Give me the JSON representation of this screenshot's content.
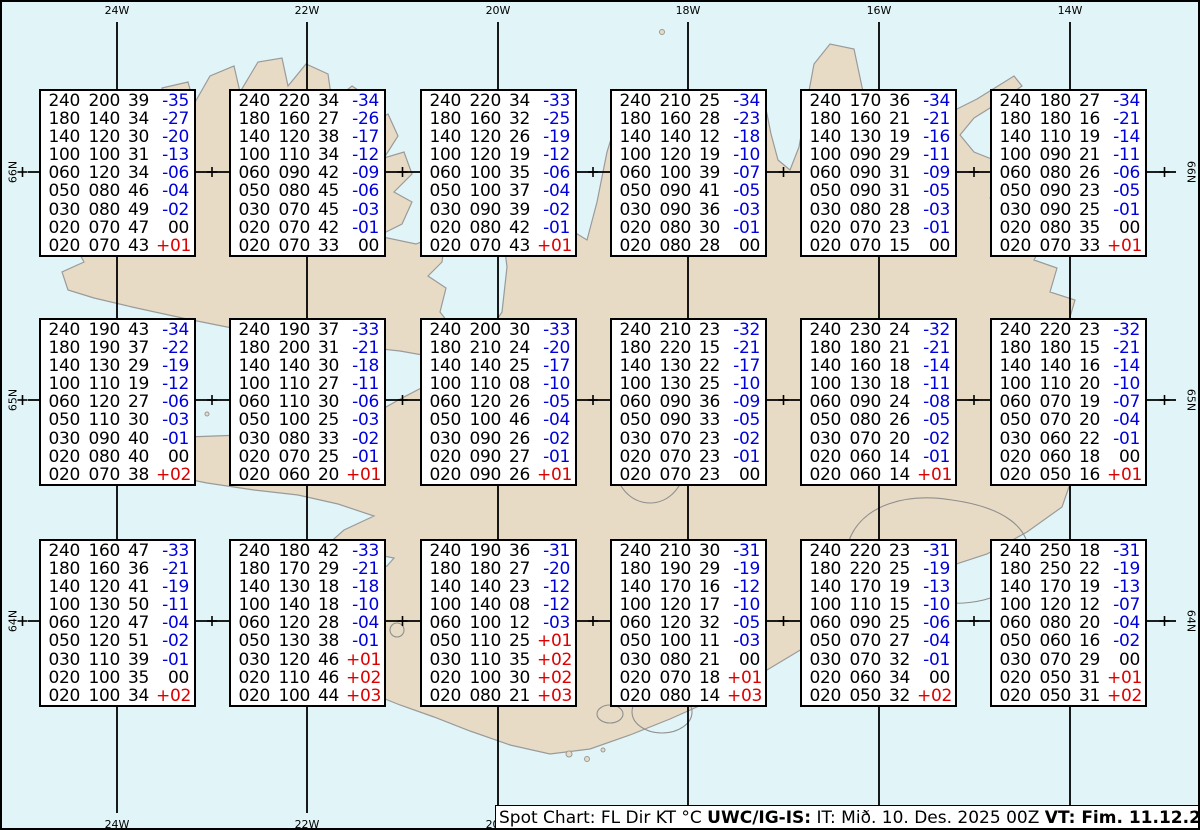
{
  "grid": {
    "top_longitude_labels": [
      "24W",
      "22W",
      "20W",
      "18W",
      "16W",
      "14W"
    ],
    "bottom_longitude_labels": [
      "24W",
      "22W",
      "20W"
    ],
    "left_latitude_labels": [
      "66N",
      "65N",
      "64N"
    ],
    "right_latitude_labels": [
      "66N",
      "65N",
      "64N"
    ]
  },
  "caption": {
    "segments": [
      {
        "text": "Spot Chart: FL Dir KT °C ",
        "bold": false
      },
      {
        "text": "UWC/IG-IS:",
        "bold": true
      },
      {
        "text": " IT: Mið. 10. Des. 2025 00Z ",
        "bold": false
      },
      {
        "text": "VT: Fim. 11.12.2025 01Z",
        "bold": true
      },
      {
        "text": " (+25 h)",
        "bold": false
      }
    ]
  },
  "colors": {
    "sea": "#e1f5f8",
    "land": "#e8dbc5",
    "coastline": "#9a9a9a",
    "negative_temp": "#0000dd",
    "positive_temp": "#dd0000",
    "grid_line": "#000000"
  },
  "chart_data": {
    "type": "table",
    "columns": [
      "FL",
      "Dir",
      "KT",
      "°C"
    ],
    "title": "Spot Chart: FL Dir KT °C UWC/IG-IS: IT: Mið. 10. Des. 2025 00Z VT: Fim. 11.12.2025 01Z (+25 h)",
    "stations": [
      {
        "row": 1,
        "col": 1,
        "rows": [
          [
            "240",
            "200",
            "39",
            "-35"
          ],
          [
            "180",
            "140",
            "34",
            "-27"
          ],
          [
            "140",
            "120",
            "30",
            "-20"
          ],
          [
            "100",
            "100",
            "31",
            "-13"
          ],
          [
            "060",
            "120",
            "34",
            "-06"
          ],
          [
            "050",
            "080",
            "46",
            "-04"
          ],
          [
            "030",
            "080",
            "49",
            "-02"
          ],
          [
            "020",
            "070",
            "47",
            "00"
          ],
          [
            "020",
            "070",
            "43",
            "+01"
          ]
        ]
      },
      {
        "row": 1,
        "col": 2,
        "rows": [
          [
            "240",
            "220",
            "34",
            "-34"
          ],
          [
            "180",
            "160",
            "27",
            "-26"
          ],
          [
            "140",
            "120",
            "38",
            "-17"
          ],
          [
            "100",
            "110",
            "34",
            "-12"
          ],
          [
            "060",
            "090",
            "42",
            "-09"
          ],
          [
            "050",
            "080",
            "45",
            "-06"
          ],
          [
            "030",
            "070",
            "45",
            "-03"
          ],
          [
            "020",
            "070",
            "42",
            "-01"
          ],
          [
            "020",
            "070",
            "33",
            "00"
          ]
        ]
      },
      {
        "row": 1,
        "col": 3,
        "rows": [
          [
            "240",
            "220",
            "34",
            "-33"
          ],
          [
            "180",
            "160",
            "32",
            "-25"
          ],
          [
            "140",
            "120",
            "26",
            "-19"
          ],
          [
            "100",
            "120",
            "19",
            "-12"
          ],
          [
            "060",
            "100",
            "35",
            "-06"
          ],
          [
            "050",
            "100",
            "37",
            "-04"
          ],
          [
            "030",
            "090",
            "39",
            "-02"
          ],
          [
            "020",
            "080",
            "42",
            "-01"
          ],
          [
            "020",
            "070",
            "43",
            "+01"
          ]
        ]
      },
      {
        "row": 1,
        "col": 4,
        "rows": [
          [
            "240",
            "210",
            "25",
            "-34"
          ],
          [
            "180",
            "160",
            "28",
            "-23"
          ],
          [
            "140",
            "140",
            "12",
            "-18"
          ],
          [
            "100",
            "120",
            "19",
            "-10"
          ],
          [
            "060",
            "100",
            "39",
            "-07"
          ],
          [
            "050",
            "090",
            "41",
            "-05"
          ],
          [
            "030",
            "090",
            "36",
            "-03"
          ],
          [
            "020",
            "080",
            "30",
            "-01"
          ],
          [
            "020",
            "080",
            "28",
            "00"
          ]
        ]
      },
      {
        "row": 1,
        "col": 5,
        "rows": [
          [
            "240",
            "170",
            "36",
            "-34"
          ],
          [
            "180",
            "160",
            "21",
            "-21"
          ],
          [
            "140",
            "130",
            "19",
            "-16"
          ],
          [
            "100",
            "090",
            "29",
            "-11"
          ],
          [
            "060",
            "090",
            "31",
            "-09"
          ],
          [
            "050",
            "090",
            "31",
            "-05"
          ],
          [
            "030",
            "080",
            "28",
            "-03"
          ],
          [
            "020",
            "070",
            "23",
            "-01"
          ],
          [
            "020",
            "070",
            "15",
            "00"
          ]
        ]
      },
      {
        "row": 1,
        "col": 6,
        "rows": [
          [
            "240",
            "180",
            "27",
            "-34"
          ],
          [
            "180",
            "180",
            "16",
            "-21"
          ],
          [
            "140",
            "110",
            "19",
            "-14"
          ],
          [
            "100",
            "090",
            "21",
            "-11"
          ],
          [
            "060",
            "080",
            "26",
            "-06"
          ],
          [
            "050",
            "090",
            "23",
            "-05"
          ],
          [
            "030",
            "090",
            "25",
            "-01"
          ],
          [
            "020",
            "080",
            "35",
            "00"
          ],
          [
            "020",
            "070",
            "33",
            "+01"
          ]
        ]
      },
      {
        "row": 2,
        "col": 1,
        "rows": [
          [
            "240",
            "190",
            "43",
            "-34"
          ],
          [
            "180",
            "190",
            "37",
            "-22"
          ],
          [
            "140",
            "130",
            "29",
            "-19"
          ],
          [
            "100",
            "110",
            "19",
            "-12"
          ],
          [
            "060",
            "120",
            "27",
            "-06"
          ],
          [
            "050",
            "110",
            "30",
            "-03"
          ],
          [
            "030",
            "090",
            "40",
            "-01"
          ],
          [
            "020",
            "080",
            "40",
            "00"
          ],
          [
            "020",
            "070",
            "38",
            "+02"
          ]
        ]
      },
      {
        "row": 2,
        "col": 2,
        "rows": [
          [
            "240",
            "190",
            "37",
            "-33"
          ],
          [
            "180",
            "200",
            "31",
            "-21"
          ],
          [
            "140",
            "140",
            "30",
            "-18"
          ],
          [
            "100",
            "110",
            "27",
            "-11"
          ],
          [
            "060",
            "110",
            "30",
            "-06"
          ],
          [
            "050",
            "100",
            "25",
            "-03"
          ],
          [
            "030",
            "080",
            "33",
            "-02"
          ],
          [
            "020",
            "070",
            "25",
            "-01"
          ],
          [
            "020",
            "060",
            "20",
            "+01"
          ]
        ]
      },
      {
        "row": 2,
        "col": 3,
        "rows": [
          [
            "240",
            "200",
            "30",
            "-33"
          ],
          [
            "180",
            "210",
            "24",
            "-20"
          ],
          [
            "140",
            "140",
            "25",
            "-17"
          ],
          [
            "100",
            "110",
            "08",
            "-10"
          ],
          [
            "060",
            "120",
            "26",
            "-05"
          ],
          [
            "050",
            "100",
            "46",
            "-04"
          ],
          [
            "030",
            "090",
            "26",
            "-02"
          ],
          [
            "020",
            "090",
            "27",
            "-01"
          ],
          [
            "020",
            "090",
            "26",
            "+01"
          ]
        ]
      },
      {
        "row": 2,
        "col": 4,
        "rows": [
          [
            "240",
            "210",
            "23",
            "-32"
          ],
          [
            "180",
            "220",
            "15",
            "-21"
          ],
          [
            "140",
            "130",
            "22",
            "-17"
          ],
          [
            "100",
            "130",
            "25",
            "-10"
          ],
          [
            "060",
            "090",
            "36",
            "-09"
          ],
          [
            "050",
            "090",
            "33",
            "-05"
          ],
          [
            "030",
            "070",
            "23",
            "-02"
          ],
          [
            "020",
            "070",
            "23",
            "-01"
          ],
          [
            "020",
            "070",
            "23",
            "00"
          ]
        ]
      },
      {
        "row": 2,
        "col": 5,
        "rows": [
          [
            "240",
            "230",
            "24",
            "-32"
          ],
          [
            "180",
            "180",
            "21",
            "-21"
          ],
          [
            "140",
            "160",
            "18",
            "-14"
          ],
          [
            "100",
            "130",
            "18",
            "-11"
          ],
          [
            "060",
            "090",
            "24",
            "-08"
          ],
          [
            "050",
            "080",
            "26",
            "-05"
          ],
          [
            "030",
            "070",
            "20",
            "-02"
          ],
          [
            "020",
            "060",
            "14",
            "-01"
          ],
          [
            "020",
            "060",
            "14",
            "+01"
          ]
        ]
      },
      {
        "row": 2,
        "col": 6,
        "rows": [
          [
            "240",
            "220",
            "23",
            "-32"
          ],
          [
            "180",
            "180",
            "15",
            "-21"
          ],
          [
            "140",
            "140",
            "16",
            "-14"
          ],
          [
            "100",
            "110",
            "20",
            "-10"
          ],
          [
            "060",
            "070",
            "19",
            "-07"
          ],
          [
            "050",
            "070",
            "20",
            "-04"
          ],
          [
            "030",
            "060",
            "22",
            "-01"
          ],
          [
            "020",
            "060",
            "18",
            "00"
          ],
          [
            "020",
            "050",
            "16",
            "+01"
          ]
        ]
      },
      {
        "row": 3,
        "col": 1,
        "rows": [
          [
            "240",
            "160",
            "47",
            "-33"
          ],
          [
            "180",
            "160",
            "36",
            "-21"
          ],
          [
            "140",
            "120",
            "41",
            "-19"
          ],
          [
            "100",
            "130",
            "50",
            "-11"
          ],
          [
            "060",
            "120",
            "47",
            "-04"
          ],
          [
            "050",
            "120",
            "51",
            "-02"
          ],
          [
            "030",
            "110",
            "39",
            "-01"
          ],
          [
            "020",
            "100",
            "35",
            "00"
          ],
          [
            "020",
            "100",
            "34",
            "+02"
          ]
        ]
      },
      {
        "row": 3,
        "col": 2,
        "rows": [
          [
            "240",
            "180",
            "42",
            "-33"
          ],
          [
            "180",
            "170",
            "29",
            "-21"
          ],
          [
            "140",
            "130",
            "18",
            "-18"
          ],
          [
            "100",
            "140",
            "18",
            "-10"
          ],
          [
            "060",
            "120",
            "28",
            "-04"
          ],
          [
            "050",
            "130",
            "38",
            "-01"
          ],
          [
            "030",
            "120",
            "46",
            "+01"
          ],
          [
            "020",
            "110",
            "46",
            "+02"
          ],
          [
            "020",
            "100",
            "44",
            "+03"
          ]
        ]
      },
      {
        "row": 3,
        "col": 3,
        "rows": [
          [
            "240",
            "190",
            "36",
            "-31"
          ],
          [
            "180",
            "180",
            "27",
            "-20"
          ],
          [
            "140",
            "140",
            "23",
            "-12"
          ],
          [
            "100",
            "140",
            "08",
            "-12"
          ],
          [
            "060",
            "100",
            "12",
            "-03"
          ],
          [
            "050",
            "110",
            "25",
            "+01"
          ],
          [
            "030",
            "110",
            "35",
            "+02"
          ],
          [
            "020",
            "100",
            "30",
            "+02"
          ],
          [
            "020",
            "080",
            "21",
            "+03"
          ]
        ]
      },
      {
        "row": 3,
        "col": 4,
        "rows": [
          [
            "240",
            "210",
            "30",
            "-31"
          ],
          [
            "180",
            "190",
            "29",
            "-19"
          ],
          [
            "140",
            "170",
            "16",
            "-12"
          ],
          [
            "100",
            "120",
            "17",
            "-10"
          ],
          [
            "060",
            "120",
            "32",
            "-05"
          ],
          [
            "050",
            "100",
            "11",
            "-03"
          ],
          [
            "030",
            "080",
            "21",
            "00"
          ],
          [
            "020",
            "070",
            "18",
            "+01"
          ],
          [
            "020",
            "080",
            "14",
            "+03"
          ]
        ]
      },
      {
        "row": 3,
        "col": 5,
        "rows": [
          [
            "240",
            "220",
            "23",
            "-31"
          ],
          [
            "180",
            "220",
            "25",
            "-19"
          ],
          [
            "140",
            "170",
            "19",
            "-13"
          ],
          [
            "100",
            "110",
            "15",
            "-10"
          ],
          [
            "060",
            "090",
            "25",
            "-06"
          ],
          [
            "050",
            "070",
            "27",
            "-04"
          ],
          [
            "030",
            "070",
            "32",
            "-01"
          ],
          [
            "020",
            "060",
            "34",
            "00"
          ],
          [
            "020",
            "050",
            "32",
            "+02"
          ]
        ]
      },
      {
        "row": 3,
        "col": 6,
        "rows": [
          [
            "240",
            "250",
            "18",
            "-31"
          ],
          [
            "180",
            "250",
            "22",
            "-19"
          ],
          [
            "140",
            "170",
            "19",
            "-13"
          ],
          [
            "100",
            "120",
            "12",
            "-07"
          ],
          [
            "060",
            "080",
            "20",
            "-04"
          ],
          [
            "050",
            "060",
            "16",
            "-02"
          ],
          [
            "030",
            "070",
            "29",
            "00"
          ],
          [
            "020",
            "050",
            "31",
            "+01"
          ],
          [
            "020",
            "050",
            "31",
            "+02"
          ]
        ]
      }
    ]
  }
}
